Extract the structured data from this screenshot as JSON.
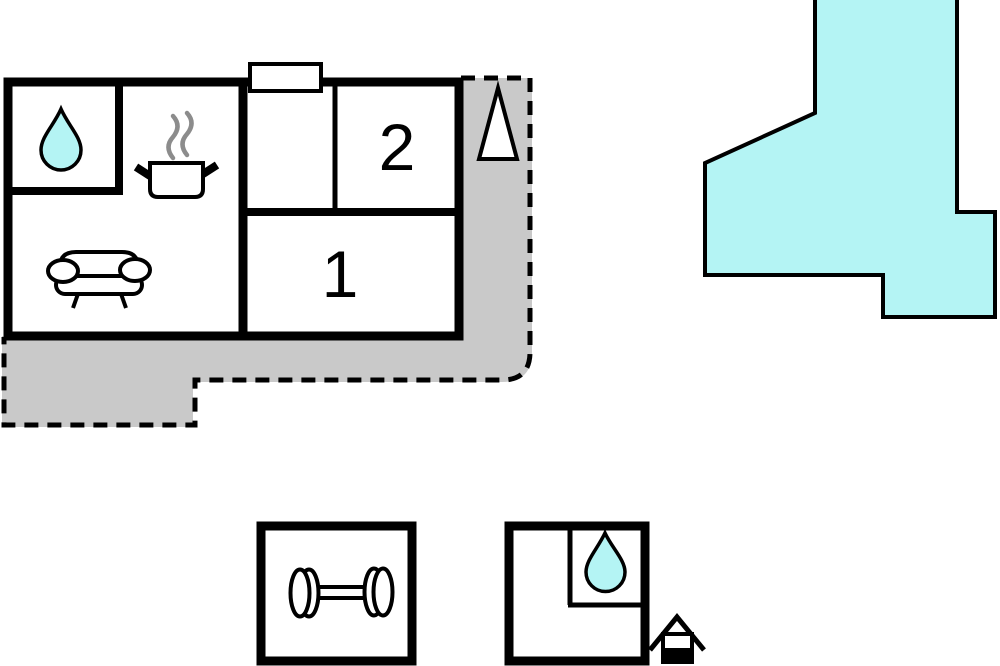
{
  "colors": {
    "water": "#b4f4f4",
    "terrace": "#c9c9c9",
    "outline": "#000000",
    "steam": "#8c8c8c",
    "background": "#ffffff"
  },
  "floor_plan": {
    "rooms": {
      "room1": {
        "label": "1"
      },
      "room2": {
        "label": "2"
      }
    },
    "icons": {
      "main_bathroom": "water-drop",
      "kitchen": "cooking-pot",
      "living_room": "sofa",
      "compass": "north-arrow",
      "gym": "dumbbell",
      "annex_bathroom": "water-drop",
      "outbuilding": "well-house"
    }
  }
}
